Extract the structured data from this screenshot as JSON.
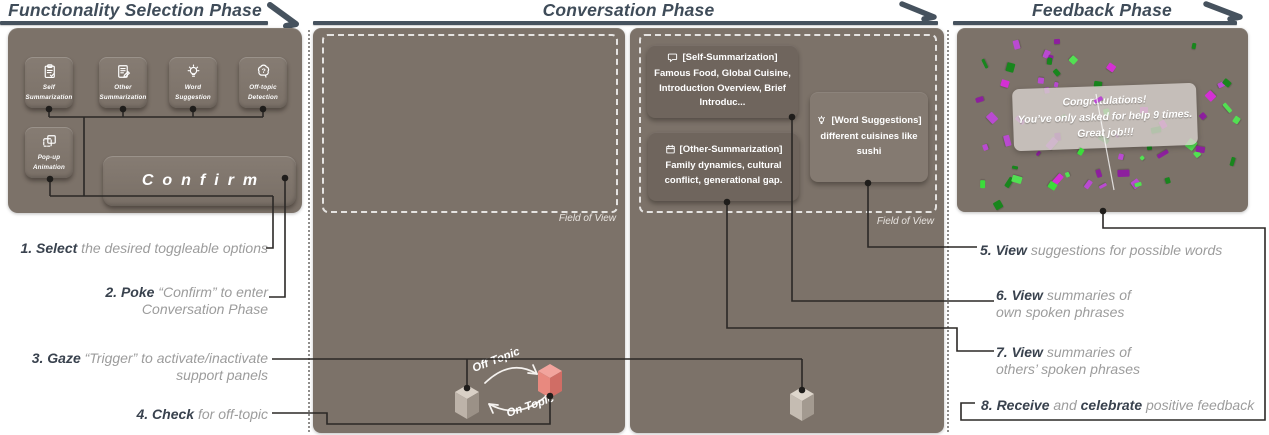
{
  "headers": {
    "functionality": "Functionality Selection Phase",
    "conversation": "Conversation Phase",
    "feedback": "Feedback Phase"
  },
  "colors": {
    "header": "#3f4c59",
    "panel_bg": "#7c7269",
    "card_bg": "#6f655d",
    "word_card_bg": "#847a71",
    "connector_line": "#2b2826",
    "step_keyword": "#39424e",
    "step_gray": "#9c9c9c",
    "cube_red": "#e8897f",
    "cube_gray": "#bdb3a9",
    "confetti": [
      "#d42fd4",
      "#8d1f9e",
      "#3bdc3b",
      "#18861d",
      "#b94ad1",
      "#52e052"
    ]
  },
  "function_panel": {
    "options": [
      {
        "label": "Self\nSummarization",
        "icon": "clipboard-check-icon"
      },
      {
        "label": "Other\nSummarization",
        "icon": "document-edit-icon"
      },
      {
        "label": "Word\nSuggestion",
        "icon": "lightbulb-icon"
      },
      {
        "label": "Off-topic\nDetection",
        "icon": "brain-question-icon"
      }
    ],
    "popup_option": {
      "label": "Pop-up\nAnimation",
      "icon": "layers-icon"
    },
    "confirm_label": "Confirm"
  },
  "conversation": {
    "field_of_view_label": "Field of View",
    "cards": {
      "self": {
        "title": "[Self-Summarization]",
        "body": "Famous Food, Global Cuisine, Introduction Overview, Brief Introduc...",
        "icon": "chat-bubble-icon"
      },
      "other": {
        "title": "[Other-Summarization]",
        "body": "Family dynamics, cultural conflict, generational gap.",
        "icon": "calendar-icon"
      },
      "word": {
        "title": "[Word Suggestions]",
        "body": "different cuisines like sushi",
        "icon": "bulb-icon"
      }
    },
    "topic_toggle": {
      "off": "Off Topic",
      "on": "On Topic"
    }
  },
  "feedback": {
    "message": [
      "Congratulations!",
      "You’ve only asked for help 9 times.",
      "Great job!!!"
    ]
  },
  "steps_left": [
    {
      "parts": [
        {
          "t": "1. Select",
          "b": 1
        },
        {
          "t": " the desired toggleable options",
          "b": 0
        }
      ]
    },
    {
      "parts": [
        {
          "t": "2. Poke",
          "b": 1
        },
        {
          "t": " “Confirm” to enter\nConversation Phase",
          "b": 0
        }
      ]
    },
    {
      "parts": [
        {
          "t": "3. Gaze",
          "b": 1
        },
        {
          "t": " “Trigger” to activate/inactivate\nsupport panels",
          "b": 0
        }
      ]
    },
    {
      "parts": [
        {
          "t": "4. Check",
          "b": 1
        },
        {
          "t": " for off-topic",
          "b": 0
        }
      ]
    }
  ],
  "steps_right": [
    {
      "parts": [
        {
          "t": "5. View",
          "b": 1
        },
        {
          "t": " suggestions for possible words",
          "b": 0
        }
      ]
    },
    {
      "parts": [
        {
          "t": "6. View",
          "b": 1
        },
        {
          "t": " summaries of\nown spoken phrases",
          "b": 0
        }
      ]
    },
    {
      "parts": [
        {
          "t": "7. View",
          "b": 1
        },
        {
          "t": " summaries of\nothers’ spoken phrases",
          "b": 0
        }
      ]
    },
    {
      "parts": [
        {
          "t": "8. Receive",
          "b": 1
        },
        {
          "t": " and ",
          "b": 0
        },
        {
          "t": "celebrate",
          "b": 1
        },
        {
          "t": " positive feedback",
          "b": 0
        }
      ]
    }
  ]
}
